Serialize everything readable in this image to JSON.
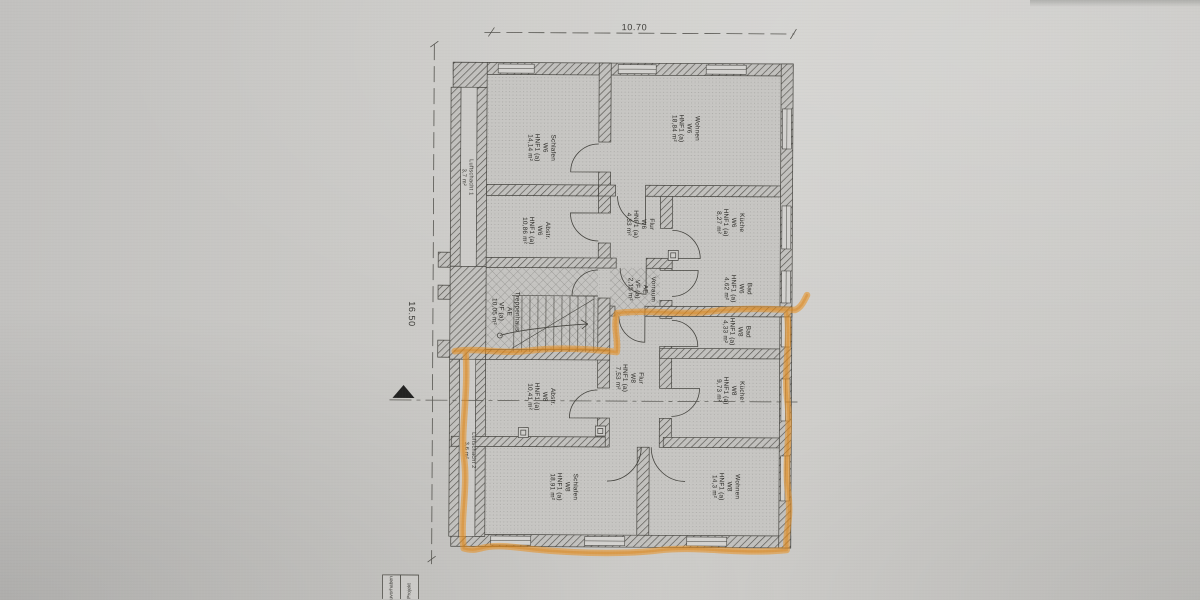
{
  "document": {
    "type": "scanned floor plan (Grundriss)",
    "highlight_note": "lower apartment W8 outlined with orange marker"
  },
  "dimensions": {
    "width": "10.70",
    "height": "16.50"
  },
  "rooms": [
    {
      "id": "schlafen-w6",
      "name": "Schlafen",
      "unit": "W6",
      "code": "HNF1 (a)",
      "area": "14,14 m²"
    },
    {
      "id": "wohnen-w6",
      "name": "Wohnen",
      "unit": "W6",
      "code": "HNF1 (a)",
      "area": "18,84 m²"
    },
    {
      "id": "abstell-w6",
      "name": "Abstr.",
      "unit": "W6",
      "code": "HNF1 (a)",
      "area": "10,86 m²"
    },
    {
      "id": "flur-w6",
      "name": "Flur",
      "unit": "W6",
      "code": "HNF1 (a)",
      "area": "4,33 m²"
    },
    {
      "id": "kueche-w6",
      "name": "Küche",
      "unit": "W6",
      "code": "HNF1 (a)",
      "area": "8,27 m²"
    },
    {
      "id": "bad-w6",
      "name": "Bad",
      "unit": "W6",
      "code": "HNF1 (a)",
      "area": "4,62 m²"
    },
    {
      "id": "treppenhaus",
      "name": "Treppenhaus",
      "unit": "AE",
      "code": "VF (a)",
      "area": "10,05 m²"
    },
    {
      "id": "vorraum",
      "name": "Vorraum",
      "unit": "AE",
      "code": "VF (a)",
      "area": "2,15 m²"
    },
    {
      "id": "bad-w8",
      "name": "Bad",
      "unit": "W8",
      "code": "HNF1 (a)",
      "area": "4,33 m²"
    },
    {
      "id": "flur-w8",
      "name": "Flur",
      "unit": "W8",
      "code": "HNF1 (a)",
      "area": "7,53 m²"
    },
    {
      "id": "kueche-w8",
      "name": "Küche",
      "unit": "W8",
      "code": "HNF1 (a)",
      "area": "9,73 m²"
    },
    {
      "id": "abstell-w8",
      "name": "Abstr.",
      "unit": "W8",
      "code": "HNF1 (a)",
      "area": "10,41 m²"
    },
    {
      "id": "schlafen-w8",
      "name": "Schlafen",
      "unit": "W8",
      "code": "HNF1 (a)",
      "area": "18,91 m²"
    },
    {
      "id": "wohnen-w8",
      "name": "Wohnen",
      "unit": "W8",
      "code": "HNF1 (a)",
      "area": "14,3 m²"
    }
  ],
  "shafts": [
    {
      "name": "Luftschacht 1",
      "area": "3,7 m²"
    },
    {
      "name": "Luftschacht 2",
      "area": "3,6 m²"
    }
  ],
  "title_block": {
    "cell1": "Bauvorhaben",
    "cell2": "Projekt"
  },
  "colors": {
    "highlight": "#ea8f1f",
    "paper": "#cbcac7",
    "ink": "#3a3935"
  }
}
